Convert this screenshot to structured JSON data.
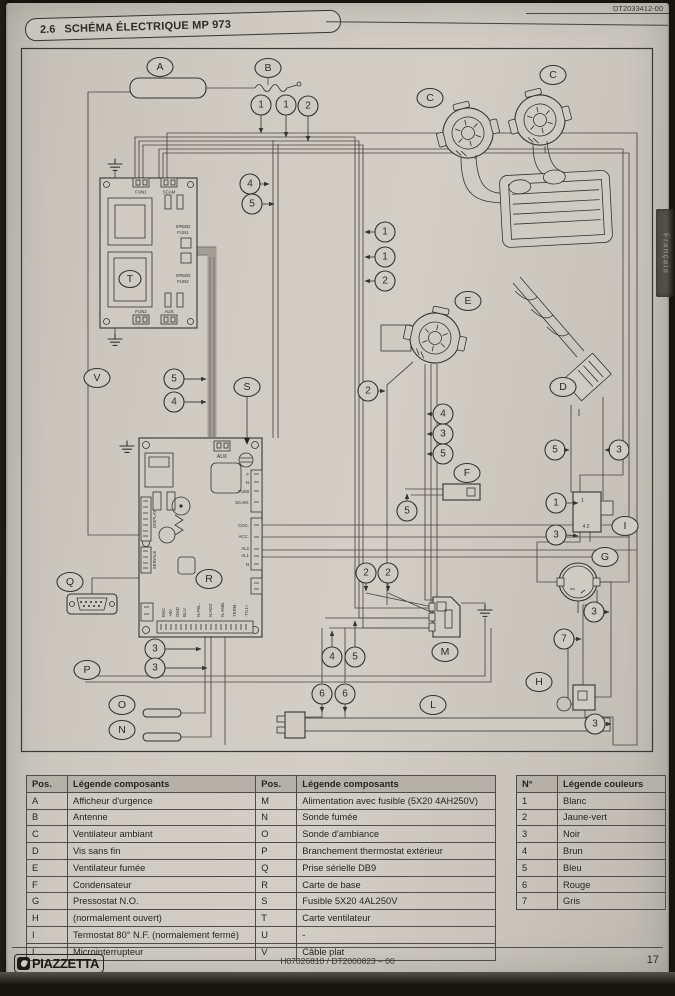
{
  "page": {
    "doc_ref_top": "DT2033412-00",
    "side_tab": "Français"
  },
  "header": {
    "section": "2.6",
    "title": "SCHÉMA ÉLECTRIQUE MP 973"
  },
  "footer": {
    "brand": "PIAZZETTA",
    "doc_code": "H07026810 / DT2000823 – 00",
    "page_number": "17"
  },
  "legend_components": {
    "col_pos": "Pos.",
    "col_label": "Légende composants",
    "left_rows": [
      [
        "A",
        "Afficheur d'urgence"
      ],
      [
        "B",
        "Antenne"
      ],
      [
        "C",
        "Ventilateur ambiant"
      ],
      [
        "D",
        "Vis sans fin"
      ],
      [
        "E",
        "Ventilateur fumée"
      ],
      [
        "F",
        "Condensateur"
      ],
      [
        "G",
        "Pressostat N.O."
      ],
      [
        "H",
        "(normalement ouvert)"
      ],
      [
        "I",
        "Termostat 80° N.F. (normalement fermé)"
      ],
      [
        "L",
        "Microinterrupteur"
      ]
    ],
    "right_rows": [
      [
        "M",
        "Alimentation avec fusible (5X20 4AH250V)"
      ],
      [
        "N",
        "Sonde fumée"
      ],
      [
        "O",
        "Sonde d'ambiance"
      ],
      [
        "P",
        "Branchement thermostat extérieur"
      ],
      [
        "Q",
        "Prise sérielle DB9"
      ],
      [
        "R",
        "Carte de base"
      ],
      [
        "S",
        "Fusible 5X20 4AL250V"
      ],
      [
        "T",
        "Carte ventilateur"
      ],
      [
        "U",
        "-"
      ],
      [
        "V",
        "Câble plat"
      ]
    ]
  },
  "legend_colors": {
    "col_num": "N°",
    "col_label": "Légende couleurs",
    "rows": [
      [
        "1",
        "Blanc"
      ],
      [
        "2",
        "Jaune-vert"
      ],
      [
        "3",
        "Noir"
      ],
      [
        "4",
        "Brun"
      ],
      [
        "5",
        "Bleu"
      ],
      [
        "6",
        "Rouge"
      ],
      [
        "7",
        "Gris"
      ]
    ]
  },
  "diagram": {
    "letters": {
      "a": "A",
      "b": "B",
      "c": "C",
      "d": "D",
      "e": "E",
      "f": "F",
      "g": "G",
      "h": "H",
      "i": "I",
      "l": "L",
      "m": "M",
      "n": "N",
      "o": "O",
      "p": "P",
      "q": "Q",
      "r": "R",
      "s": "S",
      "t": "T",
      "v": "V"
    },
    "callouts": [
      "1",
      "1",
      "2",
      "4",
      "5",
      "1",
      "1",
      "2",
      "5",
      "4",
      "2",
      "4",
      "3",
      "5",
      "5",
      "5",
      "3",
      "1",
      "3",
      "3",
      "7",
      "3",
      "2",
      "2",
      "4",
      "5",
      "6",
      "6",
      "3",
      "3"
    ],
    "board_t": {
      "top_connectors": [
        "FUN1",
        "SCAM"
      ],
      "speed1": [
        "SPEED",
        "FUN1"
      ],
      "speed2": [
        "SPEED",
        "FUN2"
      ],
      "bottom_connectors": [
        "FUN2",
        "AUX"
      ]
    },
    "board_r": {
      "aux": "AUX",
      "right_top": [
        "F",
        "N",
        "FUMI",
        "SCAM."
      ],
      "right_mid": [
        "COC.",
        "ACC.",
        "AL2",
        "AL1",
        "N"
      ],
      "left": [
        "DISPLAY",
        "SERIALE"
      ],
      "bottom": [
        "ENC",
        "+5V",
        "GND",
        "BLU",
        "N.PEL.",
        "N.H2O",
        "N.AMB.",
        "TERM.",
        "-TC1+"
      ]
    },
    "component_i": {
      "top": "1",
      "bottom": "4 2"
    }
  }
}
